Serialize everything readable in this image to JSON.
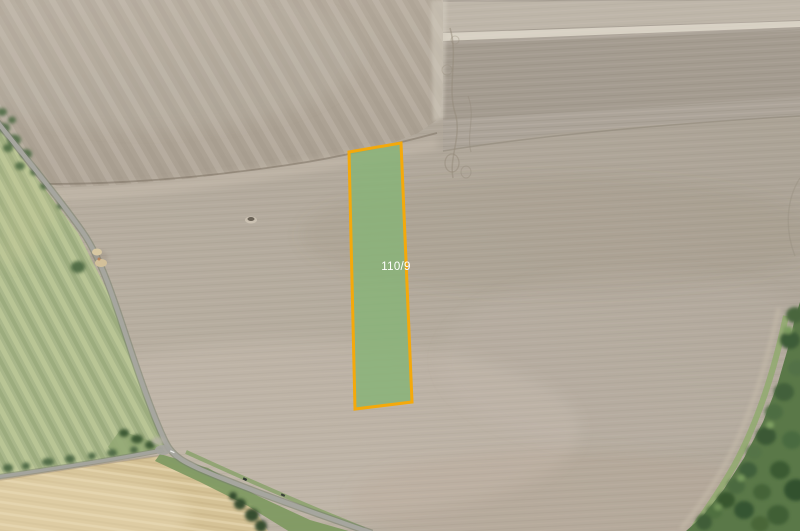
{
  "map": {
    "parcel": {
      "label": "110/9",
      "points": "349,152 401,143 412,402 355,409",
      "fill": "#88b378",
      "fill_opacity": "0.85",
      "stroke": "#f4a90b",
      "stroke_width": "3",
      "label_color": "#ffffff",
      "label_x": "396",
      "label_y": "270"
    }
  }
}
